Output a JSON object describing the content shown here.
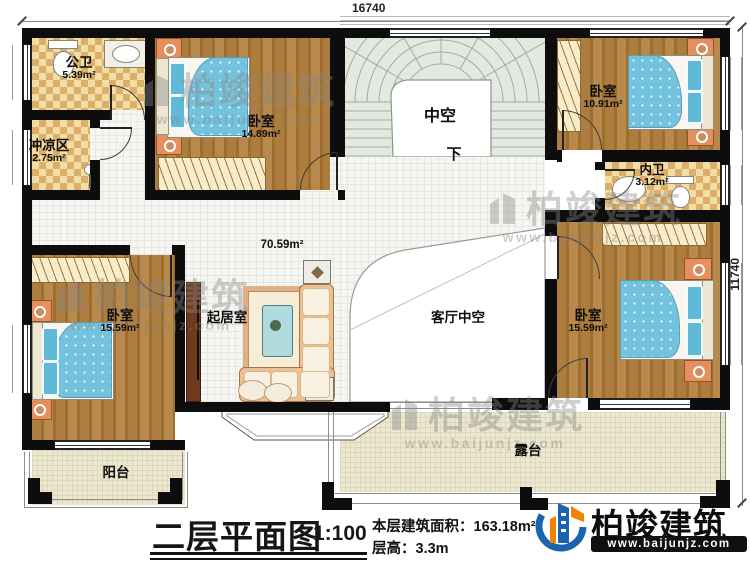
{
  "dimensions": {
    "top": "16740",
    "right": "11740"
  },
  "rooms": {
    "public_bath": {
      "name": "公卫",
      "area": "5.39m²"
    },
    "shower": {
      "name": "冲凉区",
      "area": "2.75m²"
    },
    "bedroom_top_left": {
      "name": "卧室",
      "area": "14.89m²"
    },
    "stair_void": {
      "name": "中空"
    },
    "stair_dir": "下",
    "bedroom_top_right": {
      "name": "卧室",
      "area": "10.91m²"
    },
    "ensuite_bath": {
      "name": "内卫",
      "area": "3.12m²"
    },
    "bedroom_bottom_right": {
      "name": "卧室",
      "area": "15.59m²"
    },
    "bedroom_bottom_left": {
      "name": "卧室",
      "area": "15.59m²"
    },
    "sitting_room": {
      "name": "起居室"
    },
    "living_void": {
      "name": "客厅中空"
    },
    "open_area": "70.59m²",
    "balcony": {
      "name": "阳台"
    },
    "terrace": {
      "name": "露台"
    }
  },
  "footer": {
    "title": "二层平面图",
    "scale": "1:100",
    "area_line": "本层建筑面积：163.18m²",
    "height_line": "层高：3.3m"
  },
  "brand": {
    "name": "柏竣建筑",
    "url": "www.baijunjz.com"
  },
  "watermark": {
    "name": "柏竣建筑",
    "url": "www.baijunjz.com"
  },
  "colors": {
    "wall": "#0d0d0d",
    "wood": "#a9793a",
    "tile_checker": "#e8c98e",
    "bed": "#74c3de",
    "brand_blue": "#1a63ad",
    "brand_orange": "#f08300"
  }
}
